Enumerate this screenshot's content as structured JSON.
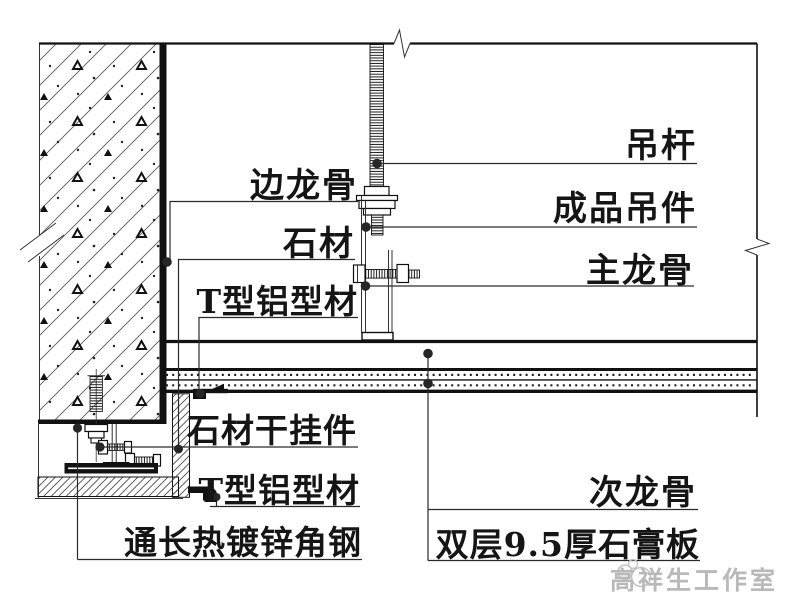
{
  "drawing": {
    "type": "architectural-section-detail",
    "title_context": "石材墙面与双层石膏板吊顶交接节点 (stone wall / gypsum ceiling junction detail)",
    "labels": {
      "diao_gan": "吊杆",
      "cheng_pin_diao_jian": "成品吊件",
      "zhu_long_gu": "主龙骨",
      "bian_long_gu": "边龙骨",
      "shi_cai": "石材",
      "t_xing_lv_xing_cai_upper": "T型铝型材",
      "shi_cai_gan_gua_jian": "石材干挂件",
      "t_xing_lv_xing_cai_lower": "T型铝型材",
      "tong_chang_re_du_xin_jiao_gang": "通长热镀锌角钢",
      "ci_long_gu": "次龙骨",
      "shuang_ceng_shi_gao_ban": "双层9.5厚石膏板"
    },
    "watermark": {
      "text": "高祥生工作室",
      "color": "#b9b9b9"
    },
    "colors": {
      "line": "#111111",
      "background": "#ffffff",
      "hatch": "#555555"
    }
  }
}
